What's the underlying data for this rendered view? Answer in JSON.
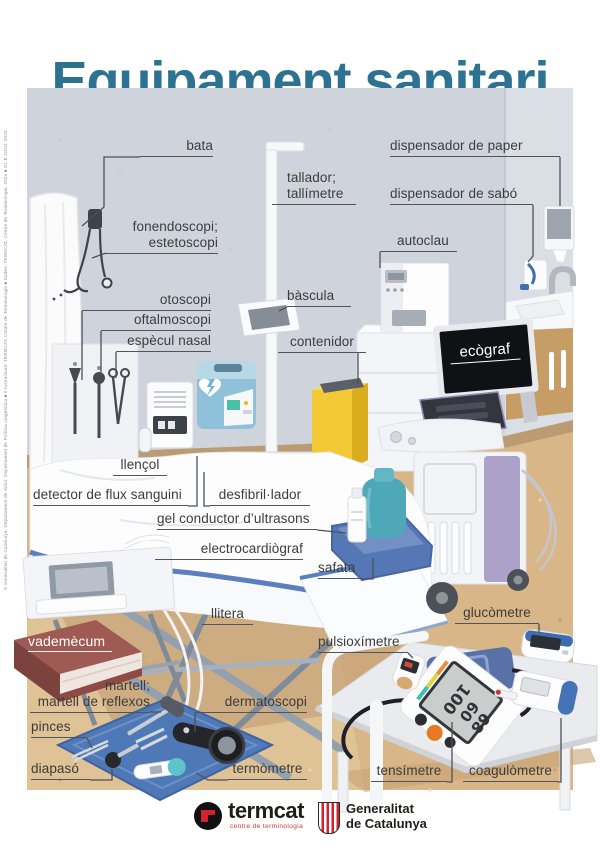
{
  "poster": {
    "title": "Equipament sanitari"
  },
  "labels": {
    "bata": "bata",
    "dispensador_de_paper": "dispensador de paper",
    "tallador": "tallador;\ntallímetre",
    "dispensador_de_sabo": "dispensador de sabó",
    "fonendoscopi": "fonendoscopi;\nestetoscopi",
    "autoclau": "autoclau",
    "otoscopi": "otoscopi",
    "bascula": "bàscula",
    "oftalmoscopi": "oftalmoscopi",
    "especul_nasal": "espècul nasal",
    "contenidor": "contenidor",
    "ecograf": "ecògraf",
    "llencol": "llençol",
    "detector_flux": "detector de flux sanguini",
    "desfibrillador": "desfibril·lador",
    "gel_conductor": "gel conductor d’ultrasons",
    "electrocardiograf": "electrocardiògraf",
    "safata": "safata",
    "llitera": "llitera",
    "glucometre": "glucòmetre",
    "vademecum": "vademècum",
    "pulsioximetre": "pulsioxímetre",
    "martell": "martell;\nmartell de reflexos",
    "dermatoscopi": "dermatoscopi",
    "pinces": "pinces",
    "diapaso": "diapasó",
    "termometre": "termòmetre",
    "tensimetre": "tensímetre",
    "coagulometre": "coagulòmetre"
  },
  "devices": {
    "tensimeter_readings": [
      "100",
      "60",
      "68"
    ]
  },
  "footer": {
    "termcat": {
      "name": "termcat",
      "tagline": "centre de terminologia"
    },
    "generalitat": {
      "name": "Generalitat\nde Catalunya"
    }
  },
  "credit": "© Generalitat de Catalunya. Departament de Salut. Departament de Política Lingüística ■ Il·lustracions: TERMCAT, Centre de Terminologia ■ Dades: TERMCAT, Centre de Terminologia, 2024 ■ DL B 11011-2024",
  "colors": {
    "title": "#2d7391",
    "wall": "#cfd4dc",
    "floor": "#d9b687",
    "tray_blue": "#4f78b7",
    "container_yellow": "#f3c936",
    "defibrillator_blue": "#8fc1da",
    "logo_red": "#d0232e"
  }
}
